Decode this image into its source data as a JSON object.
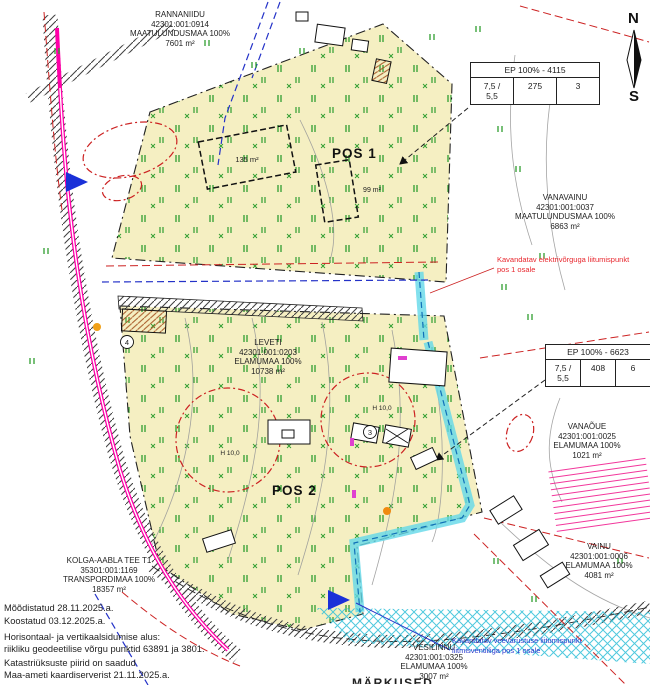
{
  "compass": {
    "north": "N",
    "south": "S"
  },
  "plot_labels": {
    "pos1": "POS 1",
    "pos2": "POS 2"
  },
  "parcels": {
    "rannaniidu": {
      "name": "RANNANIIDU",
      "cadastral": "42301:001:0914",
      "land_use": "MAATULUNDUSMAA 100%",
      "area": "7601 m²"
    },
    "vanavainu": {
      "name": "VANAVAINU",
      "cadastral": "42301:001:0037",
      "land_use": "MAATULUNDUSMAA 100%",
      "area": "6863 m²"
    },
    "leveti": {
      "name": "LEVETI",
      "cadastral": "42301:001:0203",
      "land_use": "ELAMUMAA 100%",
      "area": "10738 m²"
    },
    "vanaoue": {
      "name": "VANAÕUE",
      "cadastral": "42301:001:0025",
      "land_use": "ELAMUMAA 100%",
      "area": "1021 m²"
    },
    "vainu": {
      "name": "VAINU",
      "cadastral": "42301:001:0006",
      "land_use": "ELAMUMAA 100%",
      "area": "4081 m²"
    },
    "vesilinnu": {
      "name": "VESILINNU",
      "cadastral": "42301:001:0325",
      "land_use": "ELAMUMAA 100%",
      "area": "3007 m²"
    },
    "kolga_aabla": {
      "name": "KOLGA-AABLA TEE T1",
      "cadastral": "35301:001:1169",
      "land_use": "TRANSPORDIMAA 100%",
      "area": "18357 m²"
    }
  },
  "tables": {
    "ep1": {
      "header": "EP 100% - 4115",
      "height": "7,5 /",
      "height2": "5,5",
      "area": "275",
      "count": "3"
    },
    "ep2": {
      "header": "EP 100% - 6623",
      "height": "7,5 /",
      "height2": "5,5",
      "area": "408",
      "count": "6"
    }
  },
  "annotations": {
    "electric_line1": "Kavandatav elektrivõrguga liitumispunkt",
    "electric_line2": "pos 1 osale",
    "water_line1": "Kavandatav veevarustuse liitumispunkt",
    "water_line2": "liitmisventiiliga pos 1 osale"
  },
  "building_labels": {
    "planned1": "135 m²",
    "planned2": "99 m²"
  },
  "height_marks": {
    "h1": "H 10,0",
    "h2": "H 10,0"
  },
  "circled": {
    "c3": "3",
    "c4": "4"
  },
  "notes": {
    "l1": "Mõõdistatud  28.11.2025.a.",
    "l2": "Koostatud 03.12.2025.a.",
    "l3": "Horisontaal- ja vertikaalsidumise alus:",
    "l4": "riikliku geodeetilise võrgu punktid 63891 ja 3801.",
    "l5": "Katastriüksuste piirid on saadud",
    "l6": "Maa-ameti kaardiserverist 21.11.2025.a.",
    "heading_partial": "MÄRKUSED"
  },
  "colors": {
    "parcel_fill": "#f5efc2",
    "vegetation_green": "#2f9e30",
    "road_magenta": "#ff00a8",
    "water_cyan": "#63d8e8",
    "boundary_red": "#cc2222",
    "utility_blue": "#2432c8",
    "contour_gray": "#9a9a9a"
  }
}
